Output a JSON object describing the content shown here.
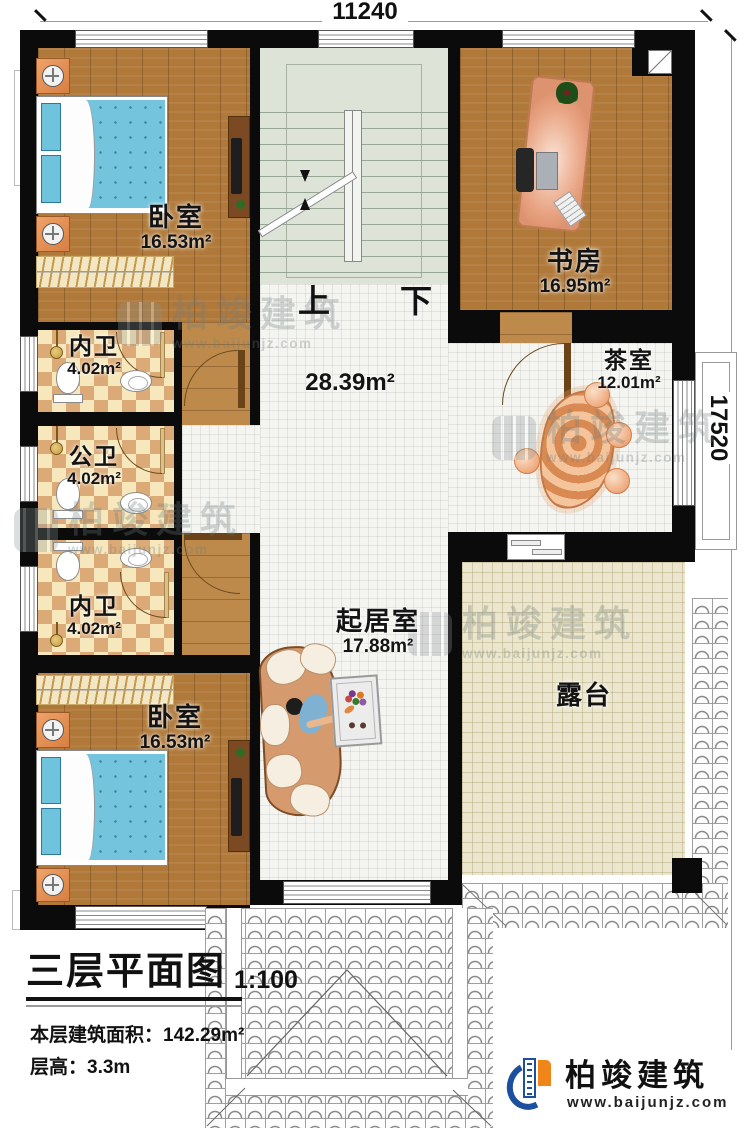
{
  "dimensions": {
    "top": "11240",
    "right": "17520"
  },
  "stairs": {
    "up_label": "上",
    "down_label": "下"
  },
  "hall": {
    "area": "28.39m²"
  },
  "rooms": {
    "bedroom_top": {
      "name": "卧室",
      "area": "16.53m²"
    },
    "bath_inner_1": {
      "name": "内卫",
      "area": "4.02m²"
    },
    "bath_public": {
      "name": "公卫",
      "area": "4.02m²"
    },
    "bath_inner_2": {
      "name": "内卫",
      "area": "4.02m²"
    },
    "bedroom_bottom": {
      "name": "卧室",
      "area": "16.53m²"
    },
    "study": {
      "name": "书房",
      "area": "16.95m²"
    },
    "tea_room": {
      "name": "茶室",
      "area": "12.01m²"
    },
    "living_room": {
      "name": "起居室",
      "area": "17.88m²"
    },
    "terrace": {
      "name": "露台"
    }
  },
  "title_block": {
    "title": "三层平面图",
    "scale": "1:100",
    "area_label": "本层建筑面积：",
    "area_value": "142.29m²",
    "floor_height_label": "层高：",
    "floor_height_value": "3.3m"
  },
  "branding": {
    "company": "柏竣建筑",
    "website": "www.baijunjz.com"
  },
  "watermark": {
    "company": "柏竣建筑",
    "website": "www.baijunjz.com"
  },
  "colors": {
    "wall": "#0b0b0b",
    "wood_floor": "#b0793a",
    "bed_blue": "#73c3dc",
    "logo_blue": "#1c4f9e",
    "logo_orange": "#f08519"
  }
}
